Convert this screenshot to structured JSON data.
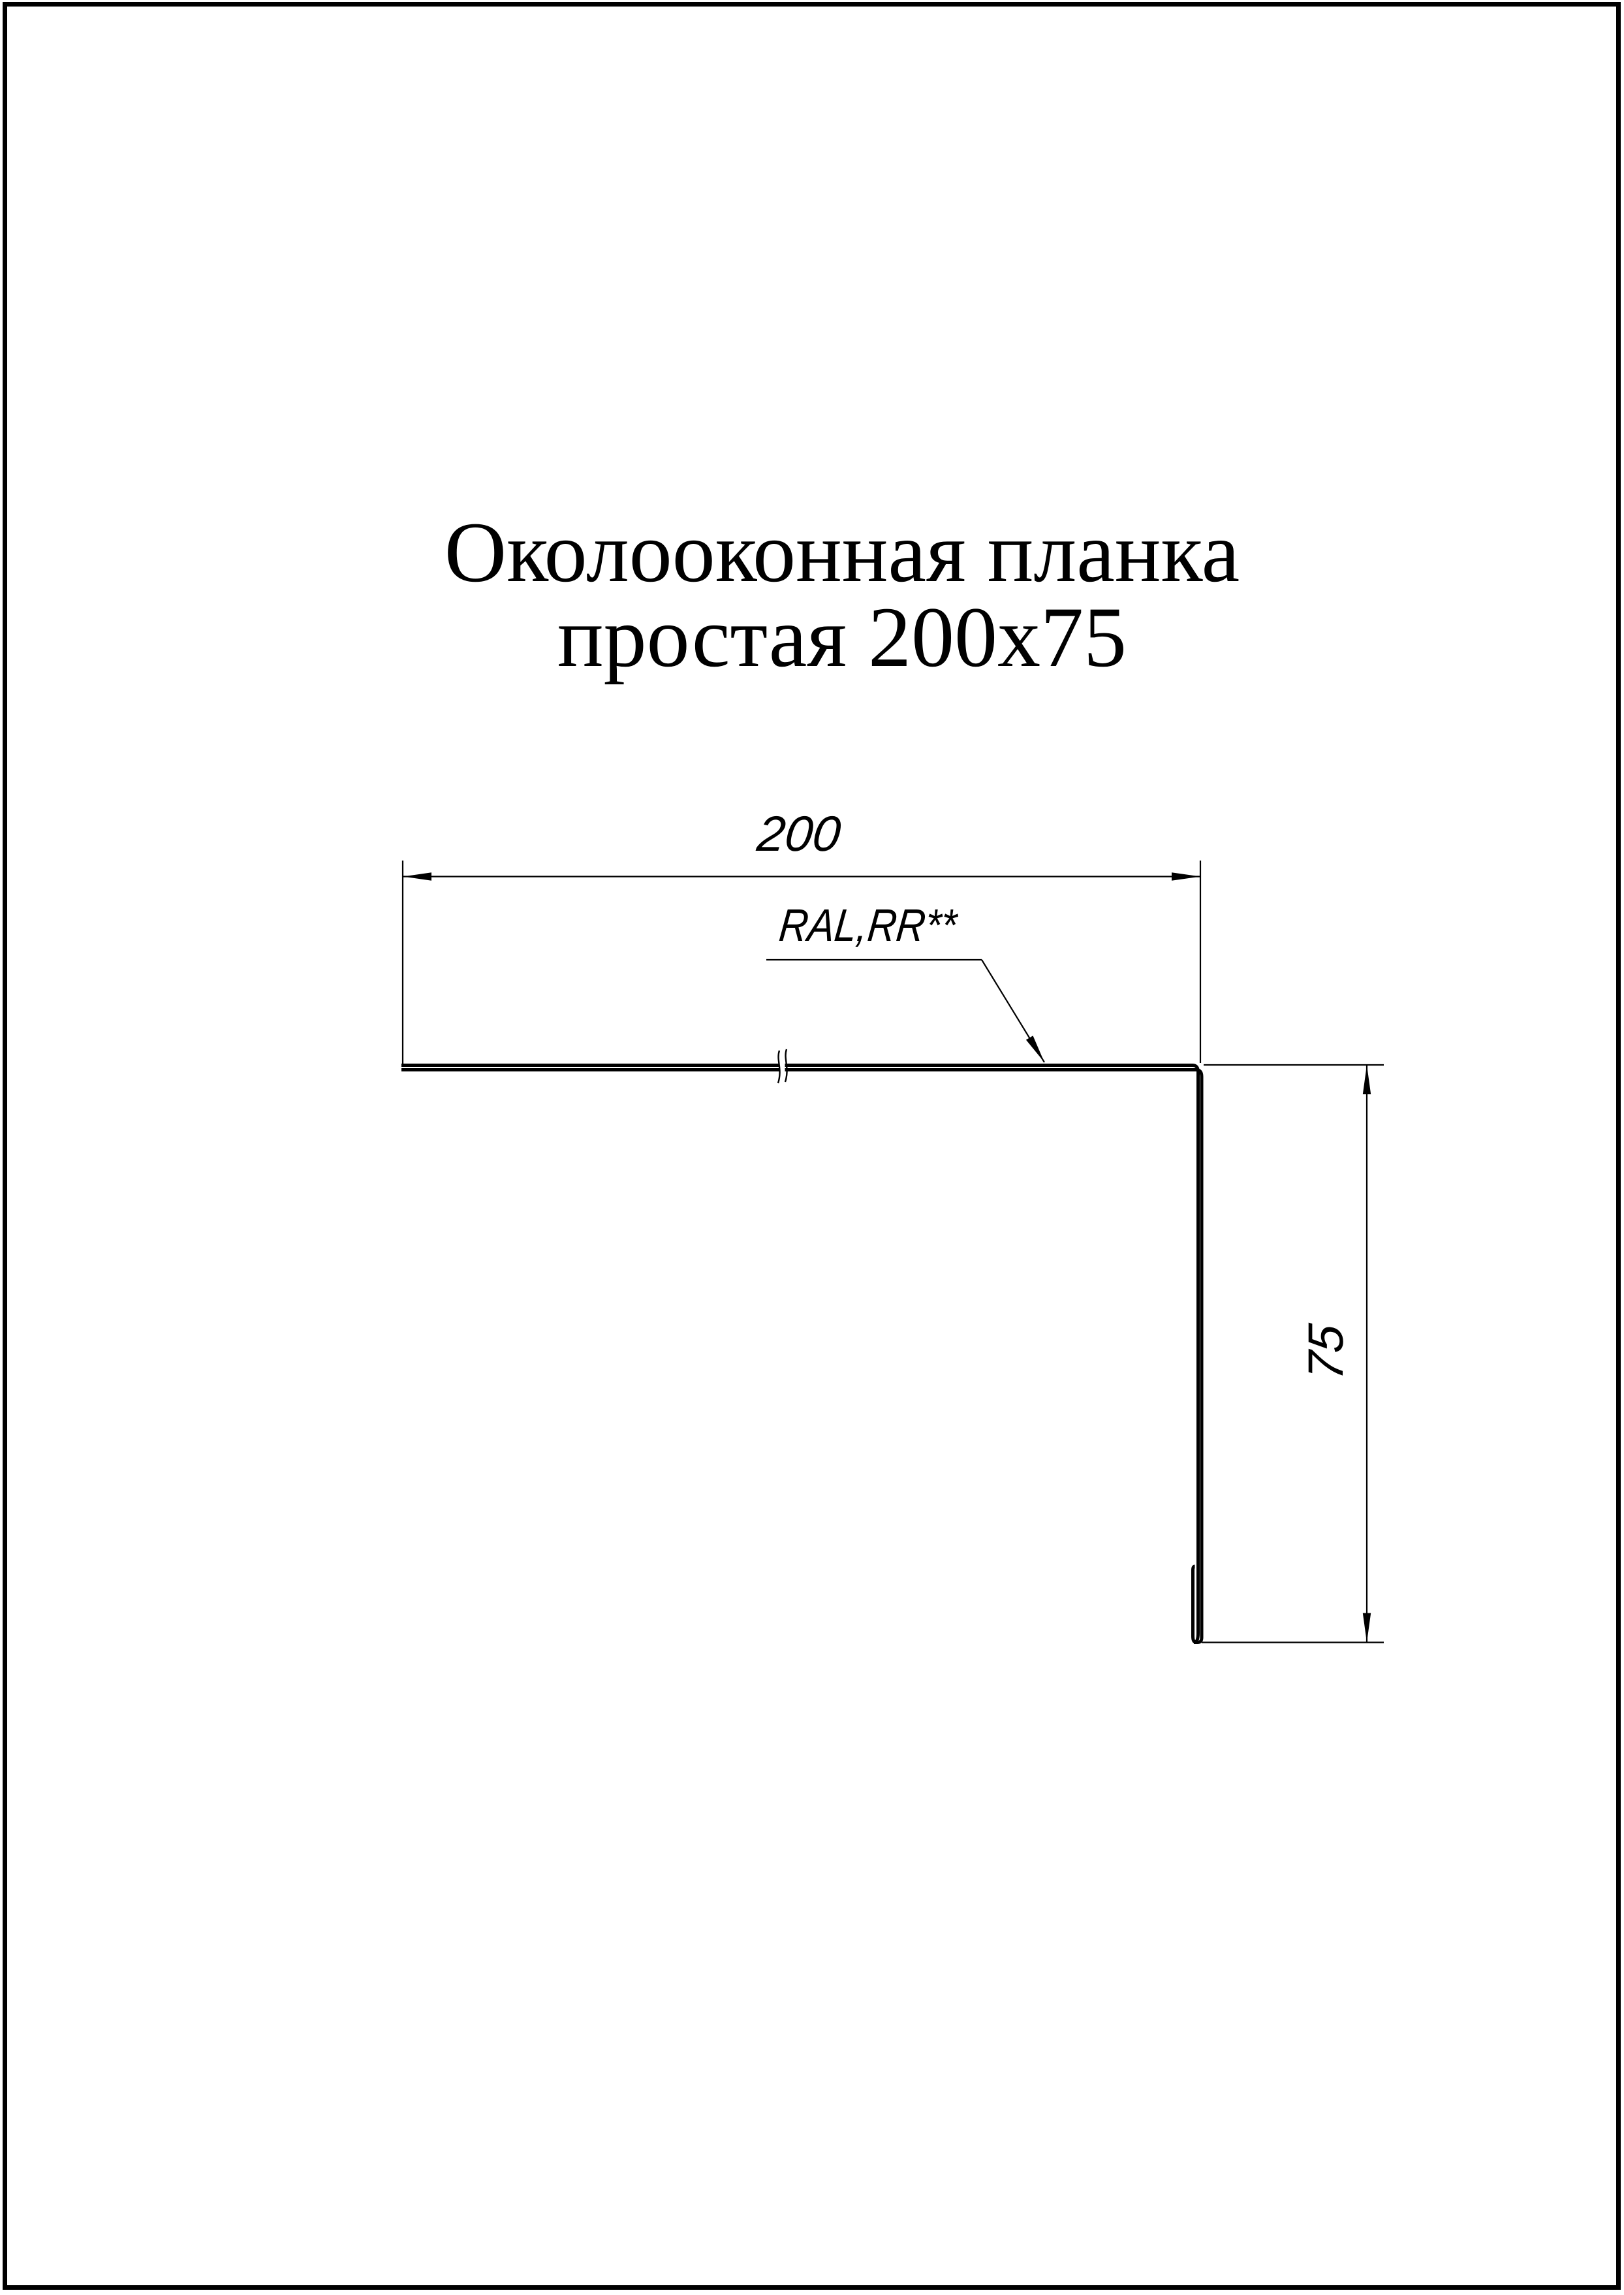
{
  "page": {
    "background_color": "#ffffff",
    "line_color": "#000000"
  },
  "title": {
    "line1": "Околооконная планка",
    "line2": "простая 200х75"
  },
  "dimensions": {
    "width_label": "200",
    "height_label": "75"
  },
  "annotations": {
    "coating_label": "RAL,RR**"
  }
}
